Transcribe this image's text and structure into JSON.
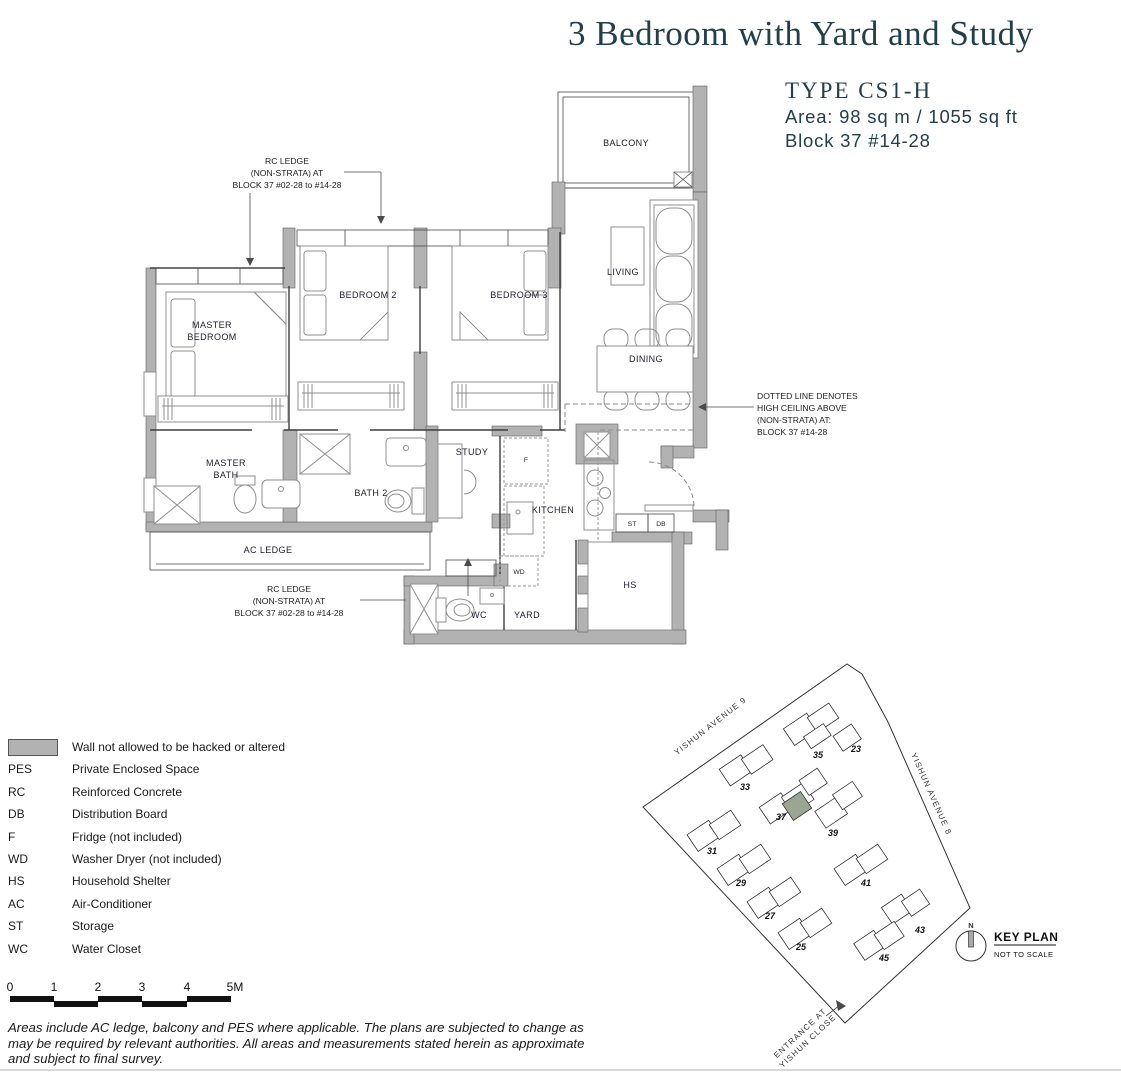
{
  "header": {
    "title": "3 Bedroom with Yard and Study",
    "type_label": "TYPE CS1-H",
    "area_label": "Area: 98 sq m / 1055 sq ft",
    "block_label": "Block 37 #14-28"
  },
  "floorplan": {
    "rooms": {
      "balcony": "BALCONY",
      "living": "LIVING",
      "dining": "DINING",
      "master_line1": "MASTER",
      "master_line2": "BEDROOM",
      "bedroom2": "BEDROOM 2",
      "bedroom3": "BEDROOM 3",
      "mbath_line1": "MASTER",
      "mbath_line2": "BATH",
      "bath2": "BATH 2",
      "study": "STUDY",
      "kitchen": "KITCHEN",
      "ac_ledge": "AC LEDGE",
      "yard": "YARD",
      "wc": "WC",
      "hs": "HS",
      "st": "ST",
      "db": "DB",
      "fridge": "F",
      "wd": "WD"
    },
    "annotations": {
      "rc_top": [
        "RC LEDGE",
        "(NON-STRATA) AT",
        "BLOCK 37 #02-28 to #14-28"
      ],
      "rc_bottom": [
        "RC LEDGE",
        "(NON-STRATA) AT",
        "BLOCK 37 #02-28 to #14-28"
      ],
      "high_ceiling": [
        "DOTTED LINE DENOTES",
        "HIGH CEILING ABOVE",
        "(NON-STRATA) AT:",
        "BLOCK 37 #14-28"
      ]
    }
  },
  "legend": {
    "items": [
      {
        "abbr": "",
        "desc": "Wall not allowed to be hacked or altered"
      },
      {
        "abbr": "PES",
        "desc": "Private Enclosed Space"
      },
      {
        "abbr": "RC",
        "desc": "Reinforced Concrete"
      },
      {
        "abbr": "DB",
        "desc": "Distribution Board"
      },
      {
        "abbr": "F",
        "desc": "Fridge (not included)"
      },
      {
        "abbr": "WD",
        "desc": "Washer Dryer (not included)"
      },
      {
        "abbr": "HS",
        "desc": "Household Shelter"
      },
      {
        "abbr": "AC",
        "desc": "Air-Conditioner"
      },
      {
        "abbr": "ST",
        "desc": "Storage"
      },
      {
        "abbr": "WC",
        "desc": "Water Closet"
      }
    ]
  },
  "scalebar": {
    "ticks": [
      "0",
      "1",
      "2",
      "3",
      "4",
      "5M"
    ]
  },
  "disclaimer": [
    "Areas include AC ledge, balcony and PES where applicable. The plans are subjected to change as",
    "may be required by relevant authorities. All areas and measurements stated herein as approximate",
    "and subject to final survey."
  ],
  "keyplan": {
    "title": "KEY PLAN",
    "subtitle": "NOT TO SCALE",
    "north_label": "N",
    "road1": "YISHUN AVENUE 9",
    "road2": "YISHUN AVENUE 8",
    "entrance_line1": "ENTRANCE AT",
    "entrance_line2": "YISHUN CLOSE",
    "blocks": [
      "35",
      "23",
      "33",
      "31",
      "29",
      "27",
      "25",
      "37",
      "39",
      "41",
      "43",
      "45"
    ],
    "highlighted_block": "37"
  },
  "colors": {
    "accent_teal": "#223f4c",
    "wall_gray": "#b2b2b2",
    "highlight_unit": "#9aa691"
  }
}
